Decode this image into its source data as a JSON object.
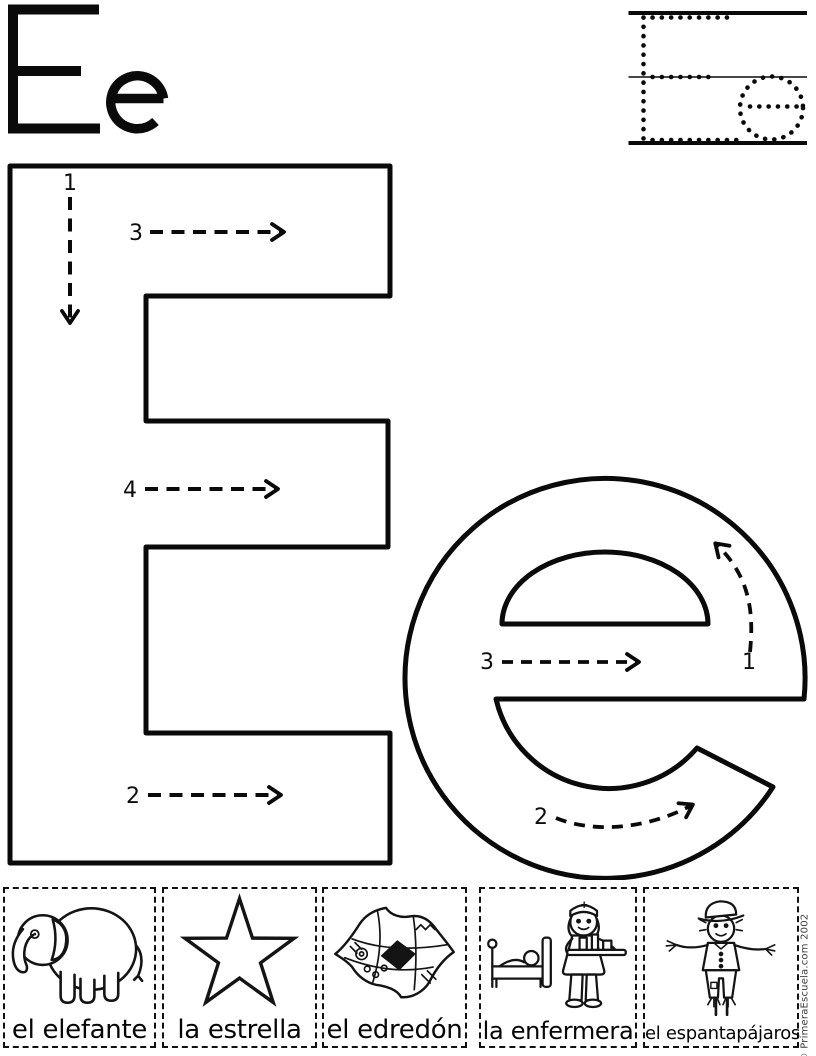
{
  "title_letters": "Ee",
  "trace_letters": {
    "upper": "E",
    "lower": "e"
  },
  "big_letters": {
    "upper": "E",
    "lower": "e"
  },
  "stroke_numbers": {
    "uppercase": {
      "s1": "1",
      "s2": "2",
      "s3": "3",
      "s4": "4"
    },
    "lowercase": {
      "s1": "1",
      "s2": "2",
      "s3": "3"
    }
  },
  "cards": [
    {
      "label": "el elefante",
      "icon": "elephant-image"
    },
    {
      "label": "la estrella",
      "icon": "star-image"
    },
    {
      "label": "el edredón",
      "icon": "quilt-image"
    },
    {
      "label": "la enfermera",
      "icon": "nurse-image"
    },
    {
      "label": "el espantapájaros",
      "icon": "scarecrow-image"
    }
  ],
  "copyright": "© PrimeraEscuela.com 2002",
  "colors": {
    "ink": "#0a0a0a",
    "paper": "#ffffff",
    "copyright_text": "#3d3d3d"
  }
}
